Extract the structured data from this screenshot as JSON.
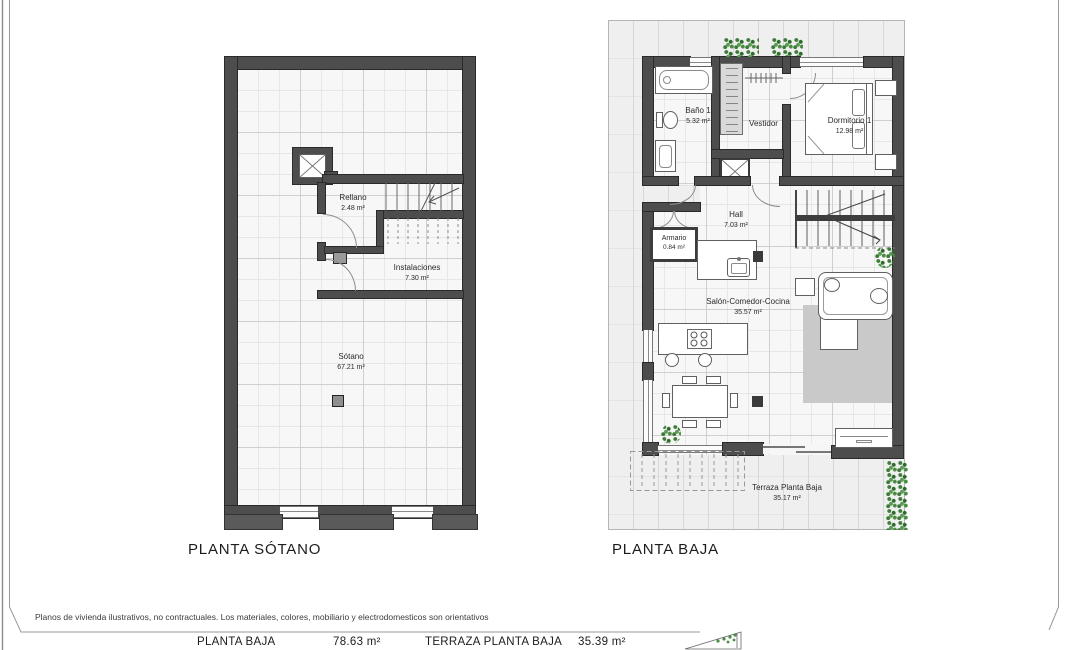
{
  "plans": {
    "sotano": {
      "title": "PLANTA SÓTANO",
      "rooms": {
        "rellano": {
          "name": "Rellano",
          "area": "2.48 m²"
        },
        "instalaciones": {
          "name": "Instalaciones",
          "area": "7.30 m²"
        },
        "sotano": {
          "name": "Sótano",
          "area": "67.21 m²"
        }
      }
    },
    "baja": {
      "title": "PLANTA BAJA",
      "rooms": {
        "bano1": {
          "name": "Baño 1",
          "area": "5.32 m²"
        },
        "vestidor": {
          "name": "Vestidor"
        },
        "dormitorio1": {
          "name": "Dormitorio 1",
          "area": "12.98 m²"
        },
        "hall": {
          "name": "Hall",
          "area": "7.03 m²"
        },
        "armario": {
          "name": "Armario",
          "area": "0.84 m²"
        },
        "salon": {
          "name": "Salón-Comedor-Cocina",
          "area": "35.57 m²"
        },
        "terraza": {
          "name": "Terraza Planta Baja",
          "area": "35.17 m²"
        }
      }
    }
  },
  "footer": {
    "disclaimer": "Planos de vivienda ilustrativos, no contractuales. Los materiales, colores, mobiliario y electrodomesticos son orientativos",
    "summary": [
      {
        "label": "PLANTA BAJA",
        "value": "78.63 m²"
      },
      {
        "label": "TERRAZA PLANTA BAJA",
        "value": "35.39 m²"
      }
    ]
  },
  "colors": {
    "wall": "#4d4d4d",
    "floor": "#f7f7f7",
    "rug": "#c9c9c9",
    "greenery": "#3e7d39"
  }
}
